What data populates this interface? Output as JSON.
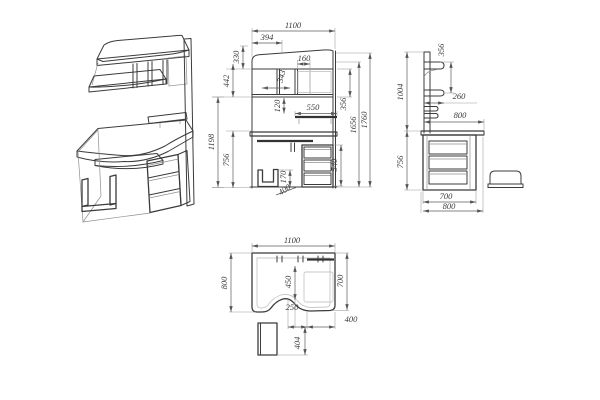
{
  "drawing": {
    "background": "#ffffff",
    "line_color": "#3b3b3b",
    "dim_text_color": "#3a3a3a",
    "views": {
      "isometric": {
        "dims": {
          "height": "1198"
        }
      },
      "front": {
        "dims": {
          "overall_width": "1100",
          "shelf_width": "394",
          "cubby_width": "160",
          "top_section_height": "330",
          "hutch_height": "442",
          "divider_spacing": "343",
          "shelf_gap": "120",
          "tray_width": "550",
          "shelf_offset": "356",
          "floor_to_shelf": "1656",
          "overall_height": "1760",
          "desk_height": "756",
          "cpu_holder_height": "170",
          "cpu_stand_width": "400",
          "drawer_unit_height": "540"
        }
      },
      "side": {
        "dims": {
          "shelf_section_height": "356",
          "hutch_height": "1004",
          "shelf_depth": "260",
          "desktop_depth": "800",
          "desk_height": "756",
          "carcass_depth": "700",
          "overall_depth": "800"
        }
      },
      "top": {
        "dims": {
          "overall_width": "1100",
          "overall_depth": "800",
          "cutout_depth": "450",
          "right_depth": "700",
          "cutout_width": "250",
          "tray_offset": "400",
          "stand_depth": "404"
        }
      }
    }
  }
}
